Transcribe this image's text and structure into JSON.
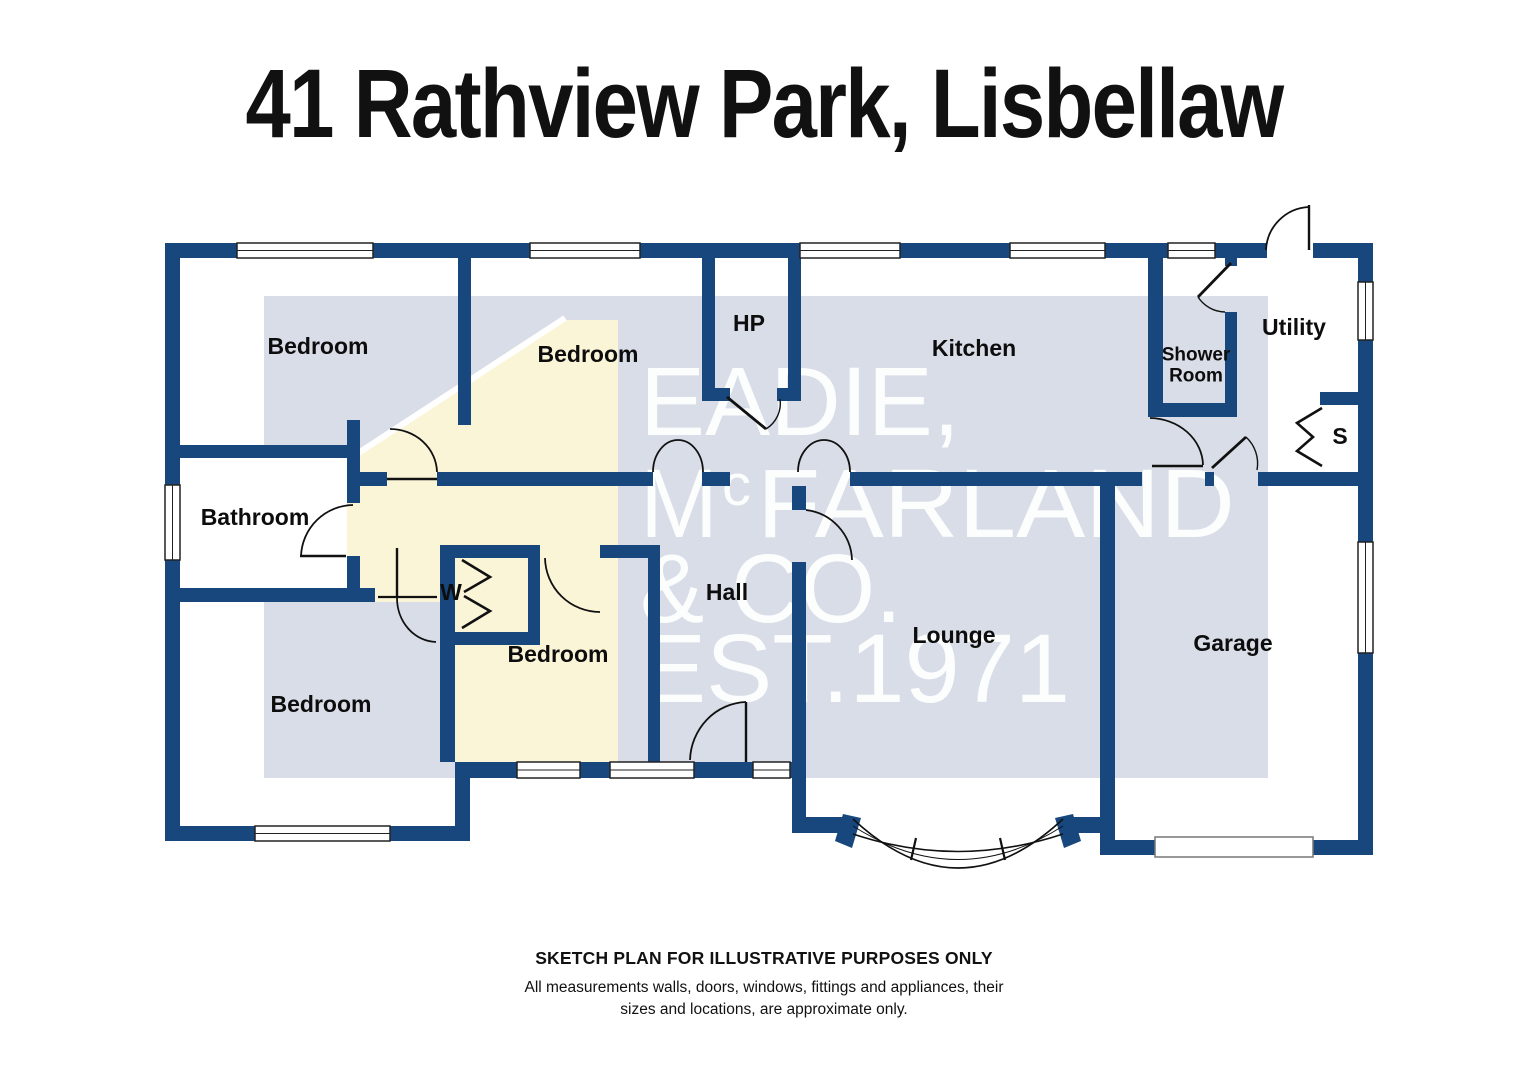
{
  "title": "41 Rathview Park, Lisbellaw",
  "watermark": {
    "line1": "EADIE,",
    "line2_pre": "M",
    "line2_sup": "c",
    "line2_post": "FARLAND",
    "line3": "& CO.",
    "line4": "EST.1971"
  },
  "rooms": [
    {
      "id": "bedroom-top-left",
      "label": "Bedroom"
    },
    {
      "id": "bedroom-top-middle",
      "label": "Bedroom"
    },
    {
      "id": "hp",
      "label": "HP"
    },
    {
      "id": "kitchen",
      "label": "Kitchen"
    },
    {
      "id": "shower-room",
      "label": "Shower\nRoom"
    },
    {
      "id": "utility",
      "label": "Utility"
    },
    {
      "id": "storage-s",
      "label": "S"
    },
    {
      "id": "bathroom",
      "label": "Bathroom"
    },
    {
      "id": "wardrobe-w",
      "label": "W"
    },
    {
      "id": "hall",
      "label": "Hall"
    },
    {
      "id": "bedroom-middle",
      "label": "Bedroom"
    },
    {
      "id": "lounge",
      "label": "Lounge"
    },
    {
      "id": "bedroom-bottom-left",
      "label": "Bedroom"
    },
    {
      "id": "garage",
      "label": "Garage"
    }
  ],
  "footer": {
    "disclaimer_title": "SKETCH PLAN FOR ILLUSTRATIVE PURPOSES ONLY",
    "disclaimer_body": "All measurements walls, doors, windows, fittings and appliances, their\nsizes and locations, are approximate only."
  },
  "colors": {
    "wall": "#17477d",
    "watermark_panel": "#d8dde7",
    "watermark_house": "#fbf5d8",
    "watermark_text": "#ffffff",
    "label_text": "#0d0d0d"
  }
}
